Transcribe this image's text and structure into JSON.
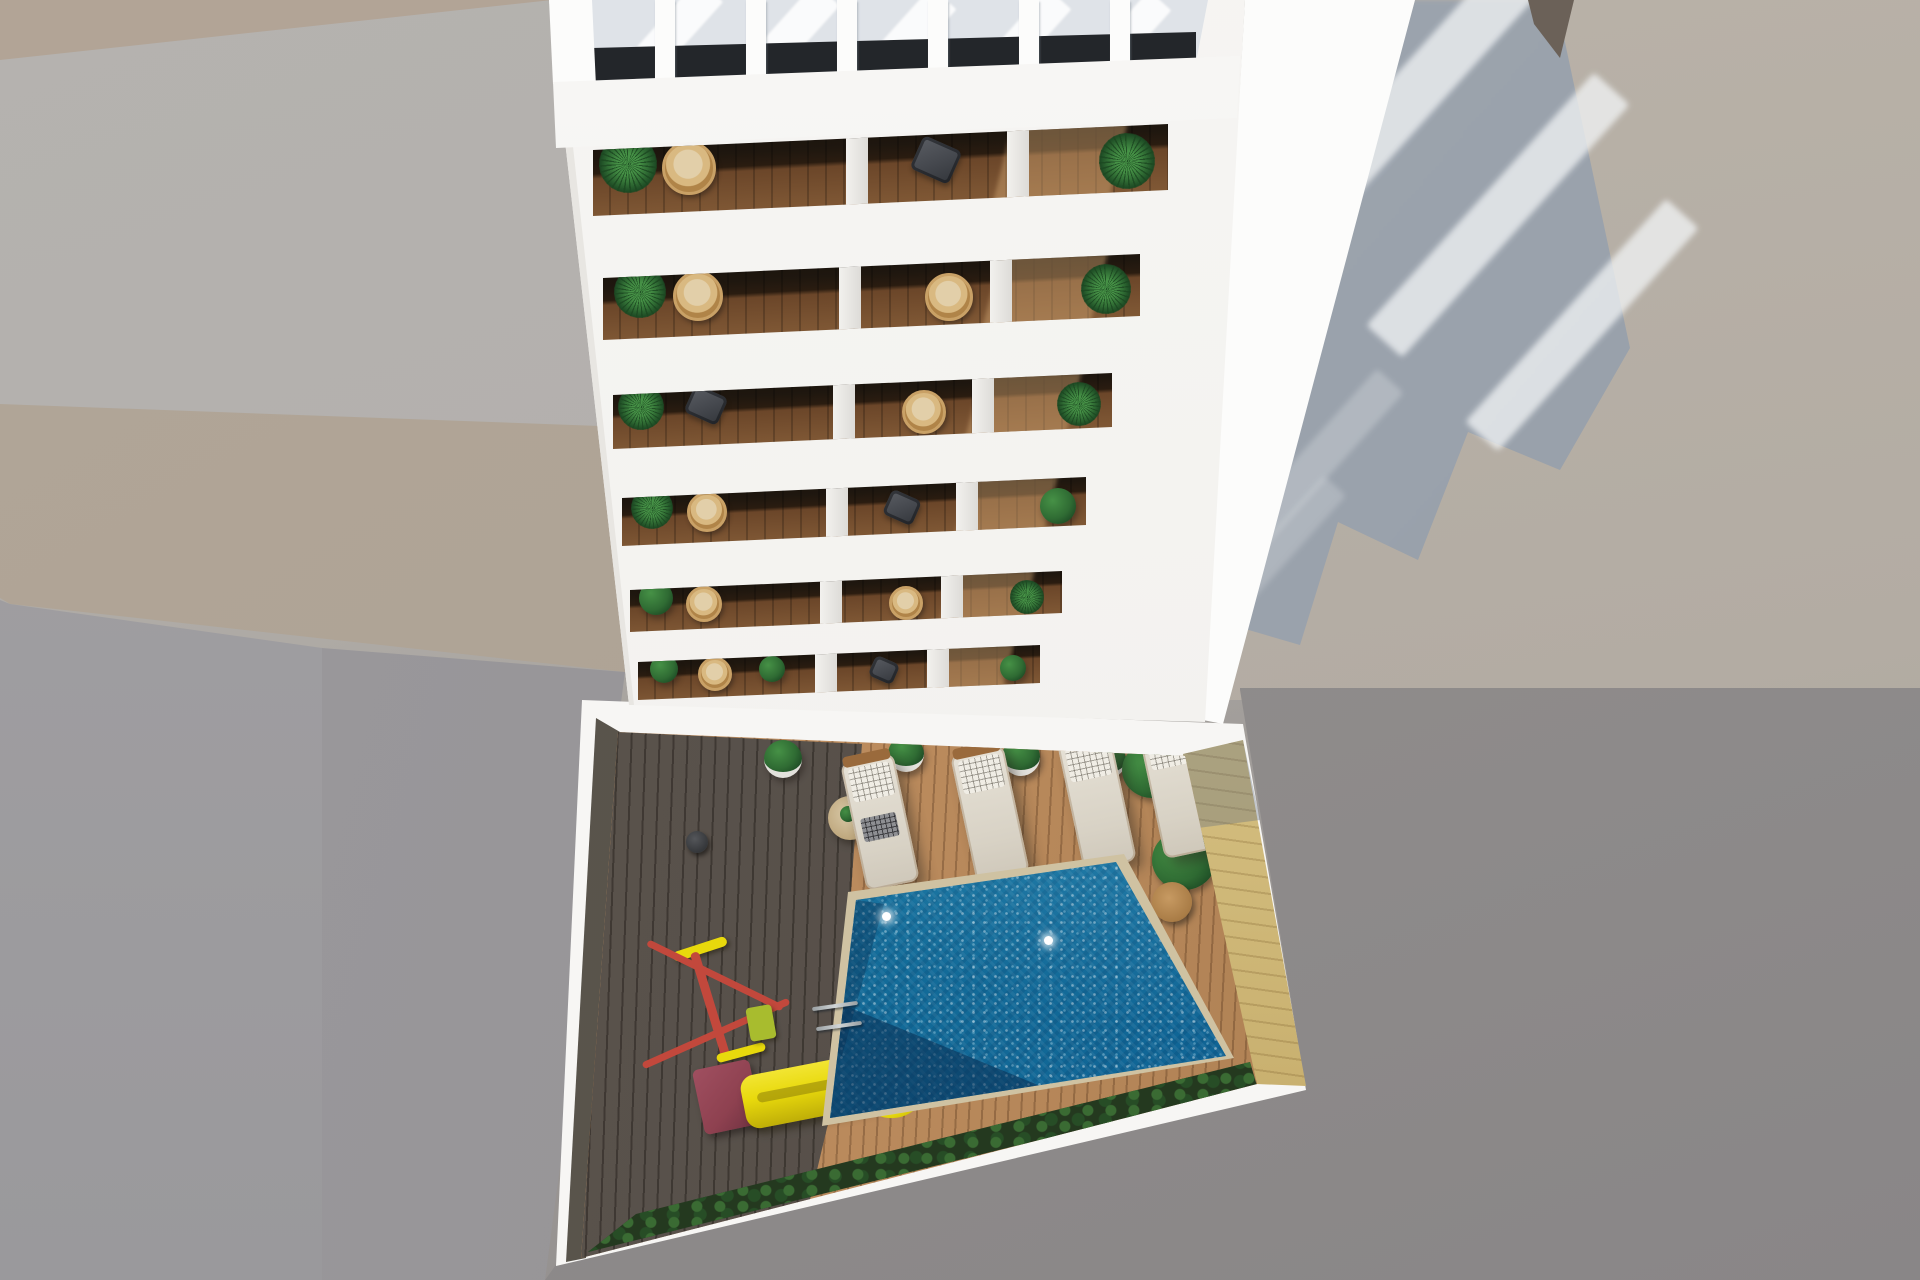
{
  "scene": {
    "type": "architectural-3d-render",
    "view": "top-down aerial view",
    "description": "Aerial 3D rendering of a white multi-storey apartment building with stacked balconies and a rooftop pergola, overlooking an inner courtyard with a swimming pool, wooden sun deck, sun loungers and a children's playground, surrounded by concrete ground with long cast shadows.",
    "time_of_day": "sunny daylight"
  },
  "counts": {
    "balcony_floors_visible": 6,
    "sun_loungers": 4,
    "deck_planters": 6,
    "pergola_slats": 6
  },
  "objects": {
    "ground": "Concrete ground and neighbouring rooftops",
    "building_shadow": "Building shadow cast on the ground",
    "facade": "White apartment building facade",
    "side_face": "Sunlit side face of the building",
    "pergola": "Rooftop pergola with slats",
    "balcony_row": "Balcony floor with two terraces, plants and wicker chairs",
    "courtyard": "Courtyard with white perimeter wall",
    "deck_dark": "Shaded part of the wooden pool deck",
    "deck_light": "Sunlit wooden pool deck",
    "pool": "Swimming pool with turquoise water",
    "pool_ladder": "Pool ladder",
    "wood_strip": "Pale timber strip along the pool wall",
    "hedge": "Green hedge along the courtyard edge",
    "loungers": "Row of cushioned sun loungers",
    "playground": "Children's playground with yellow slide",
    "planters": "Potted plants on the deck",
    "side_table": "Round side table"
  },
  "palette": {
    "bg_top": "#b9b4af",
    "bg_bottom": "#8e8b8a",
    "plaster_pink": "#b2a496",
    "plaster_beige": "#aca092",
    "concrete_gray": "#b0adaa",
    "wall_gray_light": "#a3a1a4",
    "wall_gray": "#969497",
    "shadow_blue": "#9aa2ac",
    "shadow_neutral": "#908d8c",
    "facade_white": "#f3f2ef",
    "side_white": "#fcfcfb",
    "parapet_white": "#f8f7f5",
    "pergola_gap": "#dfe3e8",
    "glass_dark": "#23262a",
    "balcony_wood": "#7c5533",
    "balcony_dark": "#16100b",
    "deck_light": "#bc8c5e",
    "deck_light_deep": "#a2764a",
    "deck_dark": "#57504a",
    "deck_dark_deep": "#413b35",
    "courtyard_white": "#f7f6f4",
    "left_wall": "#57524a",
    "pool_edge": "#cfc2a2",
    "pool_light": "#2fb0d6",
    "pool_mid": "#1b8cba",
    "pool_deep": "#0b568a",
    "wood_strip": "#d3bd7e",
    "hedge": "#24391f",
    "leaf": "#2f6b33",
    "leaf_dark": "#1d4a24",
    "leaf_light": "#469146",
    "rattan": "#c9a166",
    "rattan_fill": "#e2cfa9",
    "lounger_cream": "#e6e1d6",
    "lounger_wood": "#9a6a3c",
    "pillow": "#f0ede5",
    "chair_dark": "#45484e",
    "table_cream": "#d9c9a8",
    "table_dark": "#473827",
    "slide_yellow": "#e8d90c",
    "slide_shadow": "#bfae08",
    "play_red": "#c2483c",
    "play_maroon": "#8e4150",
    "play_lime": "#a8bc2e",
    "chrome": "#cfd4d6",
    "stripe_white": "rgba(242,244,246,0.75)"
  }
}
